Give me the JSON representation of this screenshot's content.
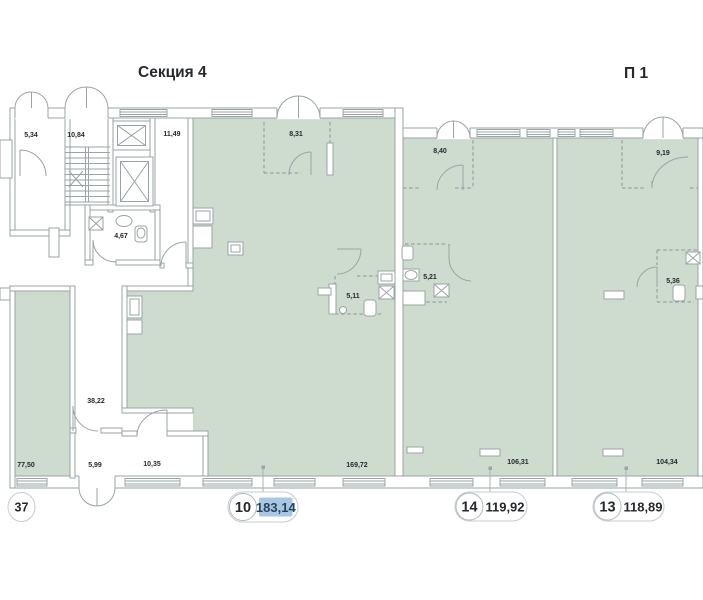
{
  "header": {
    "section_title": "Секция 4",
    "block_title": "П 1"
  },
  "rooms": {
    "r5_34": "5,34",
    "r10_84": "10,84",
    "r11_49": "11,49",
    "r4_67": "4,67",
    "r8_31": "8,31",
    "r8_40": "8,40",
    "r9_19": "9,19",
    "r5_11": "5,11",
    "r5_21": "5,21",
    "r5_36": "5,36",
    "r38_22": "38,22",
    "r77_50": "77,50",
    "r5_99": "5,99",
    "r10_35": "10,35",
    "r169_72": "169,72",
    "r106_31": "106,31",
    "r104_34": "104,34"
  },
  "badges": {
    "partial": {
      "number": "37"
    },
    "unit10": {
      "number": "10",
      "area": "183,14",
      "highlighted": true
    },
    "unit14": {
      "number": "14",
      "area": "119,92",
      "highlighted": false
    },
    "unit13": {
      "number": "13",
      "area": "118,89",
      "highlighted": false
    }
  },
  "colors": {
    "room-fill": "#cddccf",
    "wall": "#9aa3a6",
    "wall-dark": "#8a9396",
    "text": "#26292c",
    "highlight": "#a9c7e4",
    "highlight-text": "#23455c",
    "badge-border": "#c6cccf"
  }
}
